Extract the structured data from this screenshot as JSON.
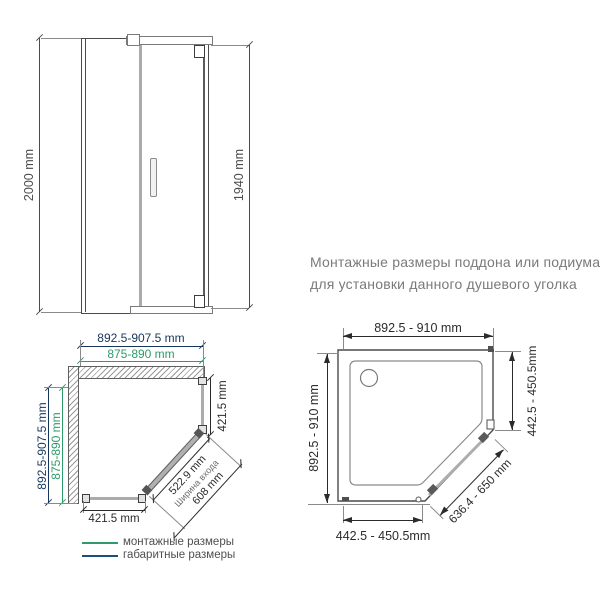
{
  "note": {
    "line1": "Монтажные размеры поддона или подиума",
    "line2": "для установки данного душевого уголка"
  },
  "front_view": {
    "overall_height": "2000 mm",
    "door_height": "1940 mm"
  },
  "corner_plan": {
    "top_overall_width": "892.5-907.5 mm",
    "top_mounting_width": "875-890 mm",
    "left_overall_depth": "892.5-907.5 mm",
    "left_mounting_depth": "875-890 mm",
    "side_glass_width": "421.5 mm",
    "bottom_glass_width": "421.5 mm",
    "entrance_width": "522.9 mm",
    "entrance_caption": "Ширина входа",
    "door_glass_width": "608 mm"
  },
  "tray_plan": {
    "top_width": "892.5 - 910 mm",
    "left_depth": "892.5 - 910 mm",
    "right_segment": "442.5 - 450.5mm",
    "bottom_segment": "442.5 - 450.5mm",
    "diagonal_segment": "636.4 - 650 mm"
  },
  "legend": {
    "mounting": {
      "label": "монтажные размеры",
      "color": "#2E9B6B"
    },
    "overall": {
      "label": "габаритные размеры",
      "color": "#1F4E79"
    }
  },
  "colors": {
    "mounting_dimension": "#2E9B6B",
    "overall_dimension": "#17365D",
    "standard_dimension": "#2B2B2B",
    "note_text": "#7A7A7A",
    "glass": "#ABABAB",
    "frame": "#4B4B4B"
  }
}
